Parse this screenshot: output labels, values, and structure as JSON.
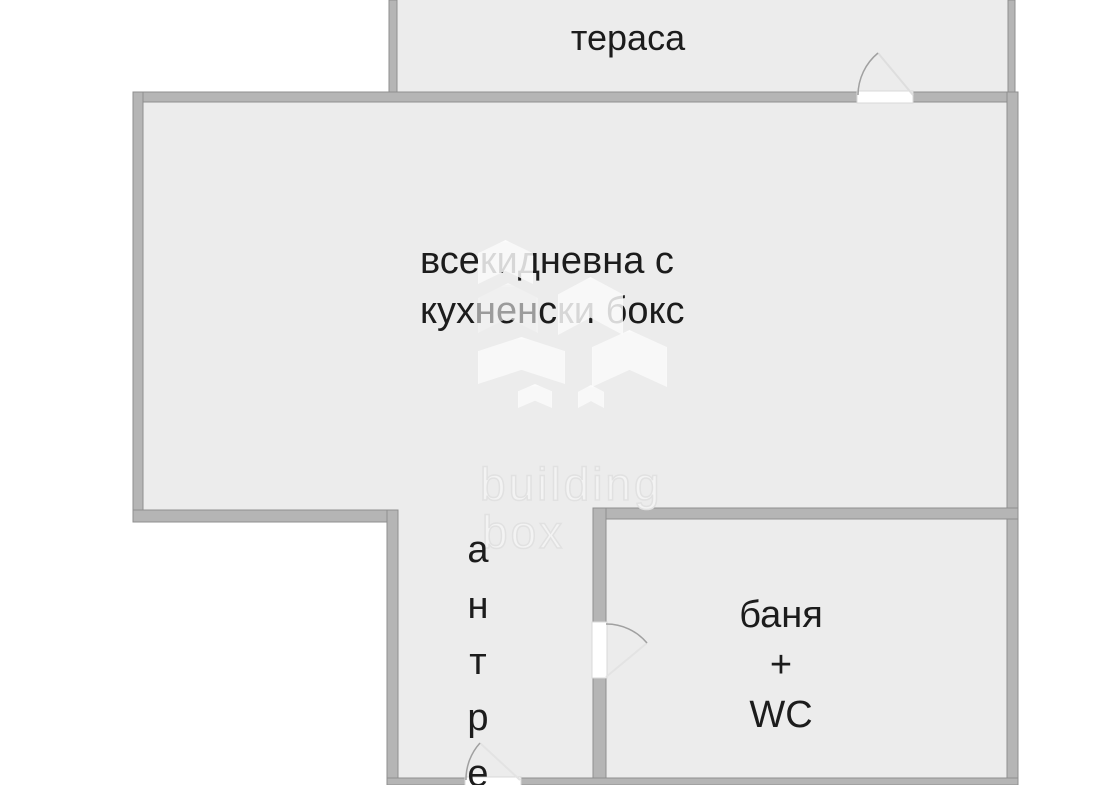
{
  "rooms": {
    "terrace": {
      "label": "тераса"
    },
    "living": {
      "label_line1": "всекидневна с",
      "label_line2": "кухненски бокс"
    },
    "hallway": {
      "label": "антре"
    },
    "bathroom": {
      "label_line1": "баня",
      "label_line2": "+",
      "label_line3": "WC"
    }
  },
  "watermark": {
    "brand_line1": "building",
    "brand_line2": "box",
    "logo": "building-box-chevron-logo"
  },
  "colors": {
    "outside": "#ffffff",
    "floor_fill": "#ececec",
    "wall_fill": "#b5b5b5",
    "wall_outline": "#8f8f8f",
    "label_text": "#1c1c1c",
    "door_arc": "#a0a0a0",
    "door_leaf": "#dedede",
    "watermark": "#e1e1e1"
  }
}
